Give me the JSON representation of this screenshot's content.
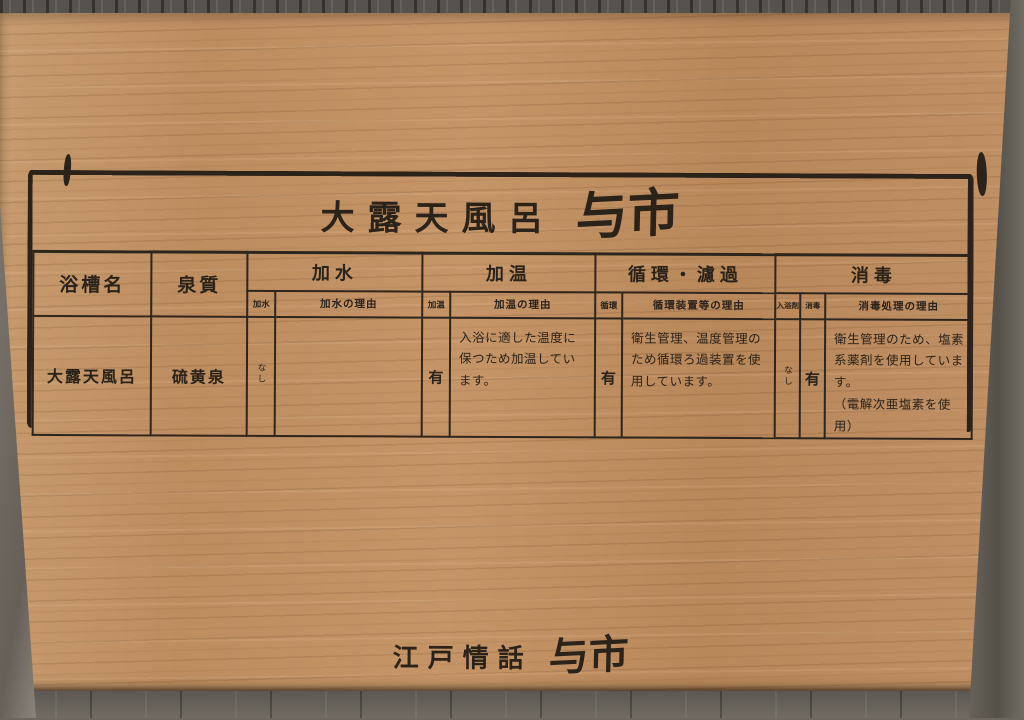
{
  "sign": {
    "title": {
      "prefix": "大露天風呂",
      "name": "与市"
    },
    "footer": {
      "prefix": "江戸情話",
      "name": "与市"
    },
    "table": {
      "headers": {
        "bath_name": "浴槽名",
        "spring_quality": "泉質",
        "kasui_group": "加水",
        "kaon_group": "加温",
        "junkan_group": "循環・濾過",
        "shodoku_group": "消毒",
        "kasui": "加水",
        "kasui_reason": "加水の理由",
        "kaon": "加温",
        "kaon_reason": "加温の理由",
        "junkan": "循環",
        "junkan_reason": "循環装置等の理由",
        "nyuyokuzai": "入浴剤",
        "shodoku": "消毒",
        "shodoku_reason": "消毒処理の理由"
      },
      "row": {
        "bath_name": "大露天風呂",
        "spring_quality": "硫黄泉",
        "kasui": "なし",
        "kasui_reason": "",
        "kaon": "有",
        "kaon_reason": "入浴に適した温度に保つため加温しています。",
        "junkan": "有",
        "junkan_reason": "衛生管理、温度管理のため循環ろ過装置を使用しています。",
        "nyuyokuzai": "なし",
        "shodoku": "有",
        "shodoku_reason": "衛生管理のため、塩素系薬剤を使用しています。",
        "shodoku_reason_note": "（電解次亜塩素を使用）"
      }
    },
    "colors": {
      "ink": "#2b221a",
      "wood": "#bf8f63",
      "wall": "#6e6861"
    }
  }
}
